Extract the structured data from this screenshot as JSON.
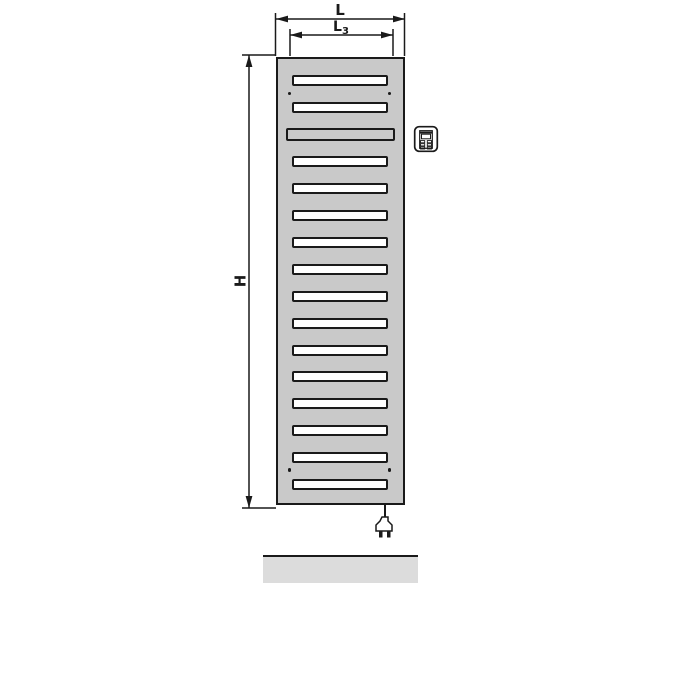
{
  "figure": {
    "type": "technical-dimension-drawing",
    "subject": "Electric bathroom radiator (towel warmer), front view with dimension lines, plug-in controller and power plug",
    "labels": {
      "overall_width": "L",
      "mounting_width_base": "L",
      "mounting_width_sub": "3",
      "overall_height": "H"
    },
    "radiator": {
      "slot_count": 16,
      "wide_slot_index": 3,
      "mounting_hole_count": 4
    },
    "icons": [
      "controller-icon",
      "power-plug-icon"
    ],
    "colors": {
      "panel": "#c9c9c9",
      "slot": "#ffffff",
      "line": "#1a1a1a",
      "floor": "#dcdcdc",
      "background": "#ffffff"
    }
  }
}
